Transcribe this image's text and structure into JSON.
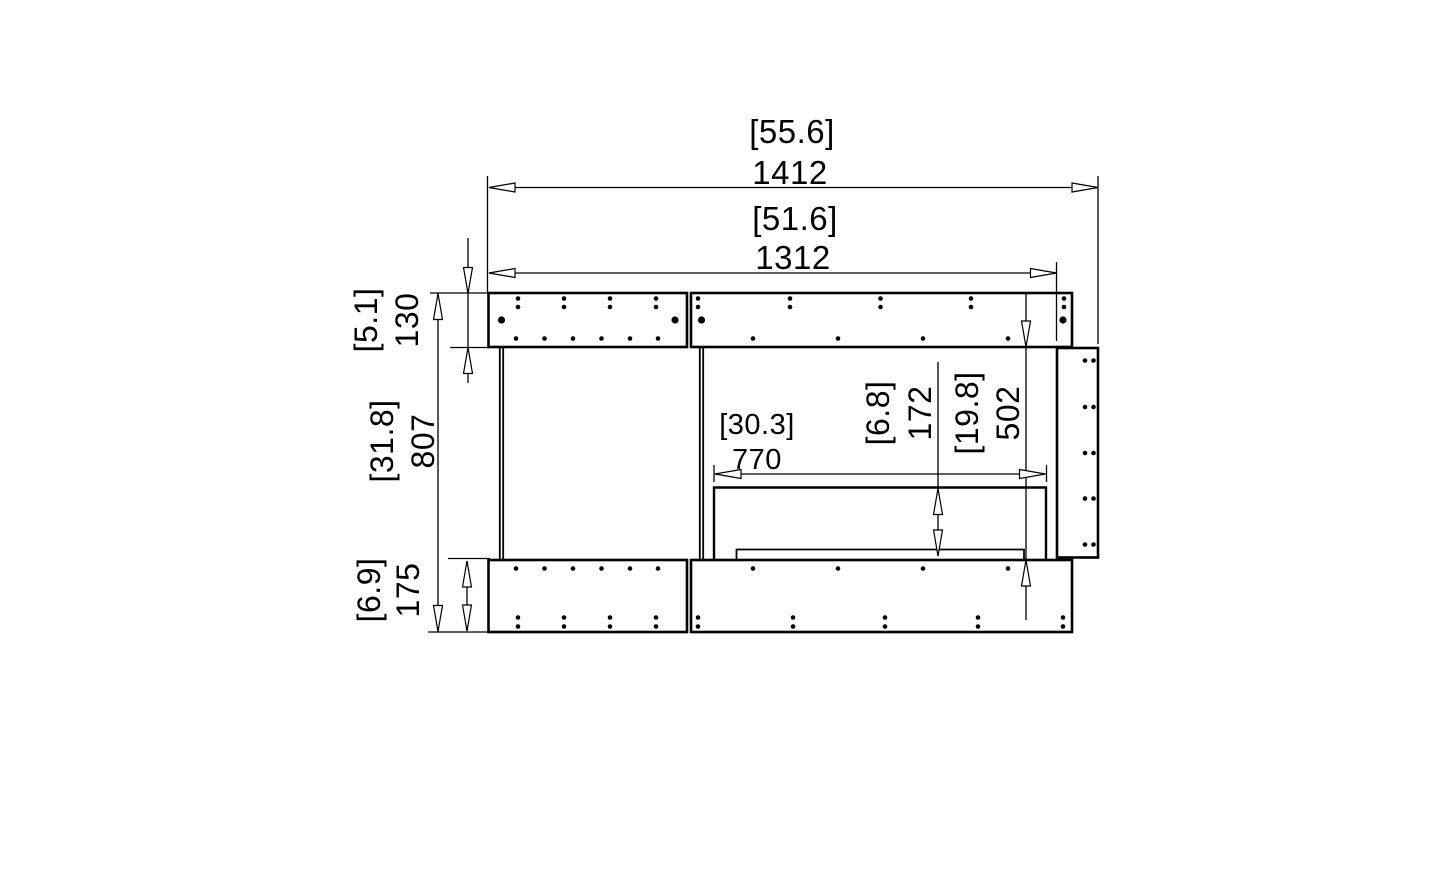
{
  "page": {
    "background_color": "#ffffff",
    "line_color": "#000000"
  },
  "drawing": {
    "type": "technical-dimension-drawing",
    "view": "front-elevation-firebox"
  },
  "dimensions": {
    "overall_width": {
      "mm": "1412",
      "inches": "[55.6]"
    },
    "internal_width": {
      "mm": "1312",
      "inches": "[51.6]"
    },
    "top_panel_height": {
      "mm": "130",
      "inches": "[5.1]"
    },
    "overall_height": {
      "mm": "807",
      "inches": "[31.8]"
    },
    "base_height": {
      "mm": "175",
      "inches": "[6.9]"
    },
    "burner_opening_width": {
      "mm": "770",
      "inches": "[30.3]"
    },
    "burner_to_floor": {
      "mm": "172",
      "inches": "[6.8]"
    },
    "opening_height": {
      "mm": "502",
      "inches": "[19.8]"
    }
  }
}
